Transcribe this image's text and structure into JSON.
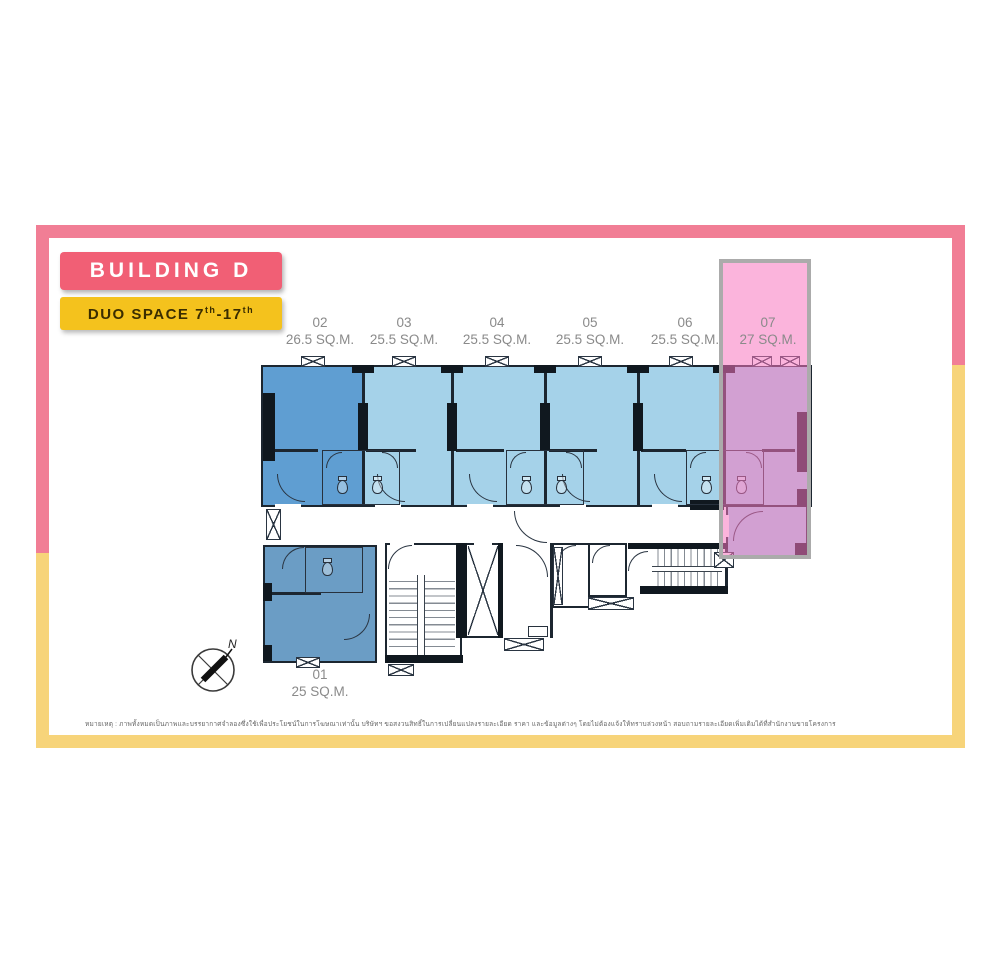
{
  "header": {
    "building_label": "BUILDING D",
    "duo_prefix": "DUO SPACE 7",
    "duo_sup1": "th",
    "duo_mid": "-17",
    "duo_sup2": "th"
  },
  "units": [
    {
      "id": "01",
      "area": "25 SQ.M.",
      "highlighted": false
    },
    {
      "id": "02",
      "area": "26.5 SQ.M.",
      "highlighted": false
    },
    {
      "id": "03",
      "area": "25.5 SQ.M.",
      "highlighted": false
    },
    {
      "id": "04",
      "area": "25.5 SQ.M.",
      "highlighted": false
    },
    {
      "id": "05",
      "area": "25.5 SQ.M.",
      "highlighted": false
    },
    {
      "id": "06",
      "area": "25.5 SQ.M.",
      "highlighted": false
    },
    {
      "id": "07",
      "area": "27 SQ.M.",
      "highlighted": true
    }
  ],
  "compass": {
    "label": "N"
  },
  "disclaimer": "หมายเหตุ : ภาพทั้งหมดเป็นภาพและบรรยากาศจำลองซึ่งใช้เพื่อประโยชน์ในการโฆษณาเท่านั้น บริษัทฯ ขอสงวนสิทธิ์ในการเปลี่ยนแปลงรายละเอียด ราคา และข้อมูลต่างๆ โดยไม่ต้องแจ้งให้ทราบล่วงหน้า สอบถามรายละเอียดเพิ่มเติมได้ที่สำนักงานขายโครงการ",
  "colors": {
    "accent_pink": "#f15f75",
    "accent_yellow": "#f4c21d",
    "frame_pink": "#f17e95",
    "frame_yellow": "#f7d47a",
    "highlight_pink": "#f876bf",
    "highlight_border_gray": "#ababab",
    "unit_dark_blue": "#5f9ed2",
    "unit_light_blue": "#a5d2e9",
    "unit01_blue": "#6b9dc5",
    "wall_dark": "#1c2630",
    "label_gray": "#8a8a8a"
  }
}
